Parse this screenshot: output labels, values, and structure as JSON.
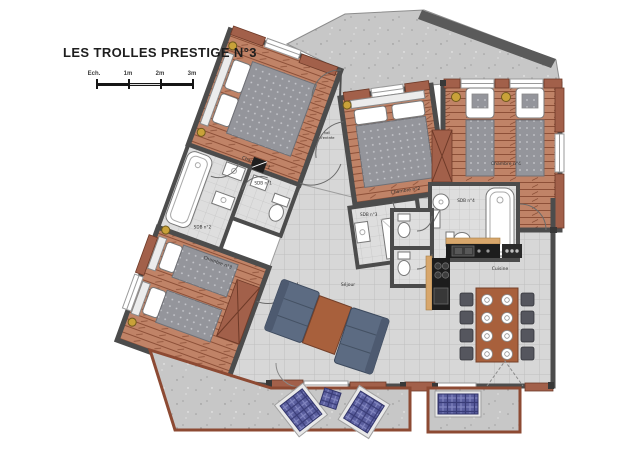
{
  "header": {
    "title": "LES TROLLES PRESTIGE N°3"
  },
  "scale_bar": {
    "label": "Ech.",
    "marks": [
      "1m",
      "2m",
      "3m"
    ]
  },
  "rooms": {
    "chambre1": "Chambre n°1",
    "chambre2": "Chambre n°2",
    "chambre3": "Chambre n°3",
    "chambre4": "Chambre n°4",
    "sdb1": "SDB n°1",
    "sdb2": "SDB n°2",
    "sdb3": "SDB n°3",
    "sdb4": "SDB n°4",
    "hall_line1": "hall",
    "hall_line2": "d'entrée",
    "sejour": "Séjour",
    "cuisine": "Cuisine"
  },
  "colors": {
    "wall": "#4c4c4c",
    "wood_floor": "#c08367",
    "wood_line": "#8d5038",
    "tile_floor": "#d7d7d7",
    "concrete": "#c7c7c7",
    "brick": "#a2604a",
    "mattress": "#94959b",
    "sofa": "#5c6b82",
    "wood_furniture": "#a8603c",
    "plaid_fabric": "#5a5e9e",
    "lamp_gold": "#c9a239",
    "counter_black": "#1d1d1d"
  }
}
